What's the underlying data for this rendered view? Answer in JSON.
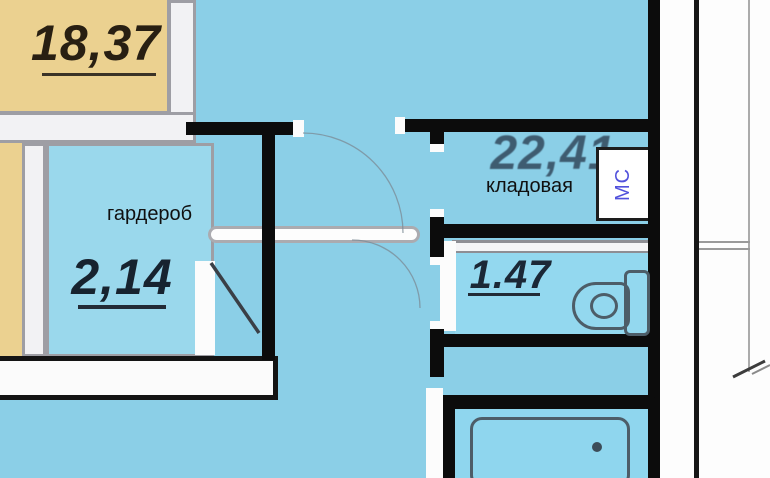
{
  "plan": {
    "rooms": {
      "top_left": {
        "area": "18,37"
      },
      "wardrobe": {
        "name": "гардероб",
        "area": "2,14"
      },
      "storage": {
        "name": "кладовая",
        "area": "22,41"
      },
      "bathroom": {
        "area": "1.47"
      },
      "riser": {
        "label": "МС"
      }
    },
    "fixtures": {
      "toilet": "toilet-icon",
      "bathtub": "bathtub-icon"
    },
    "colors": {
      "background_blue": "#8BCFE7",
      "room_blue": "#9AD8EC",
      "bathroom_blue": "#93D8EF",
      "beige": "#EBD190",
      "wall_black": "#0C0C0C",
      "wall_gray": "#9E9EA4",
      "area_text": "#17232F",
      "storage_area_text": "#31485C",
      "riser_text": "#5151DC",
      "margin_white": "#FDFDFD"
    }
  }
}
